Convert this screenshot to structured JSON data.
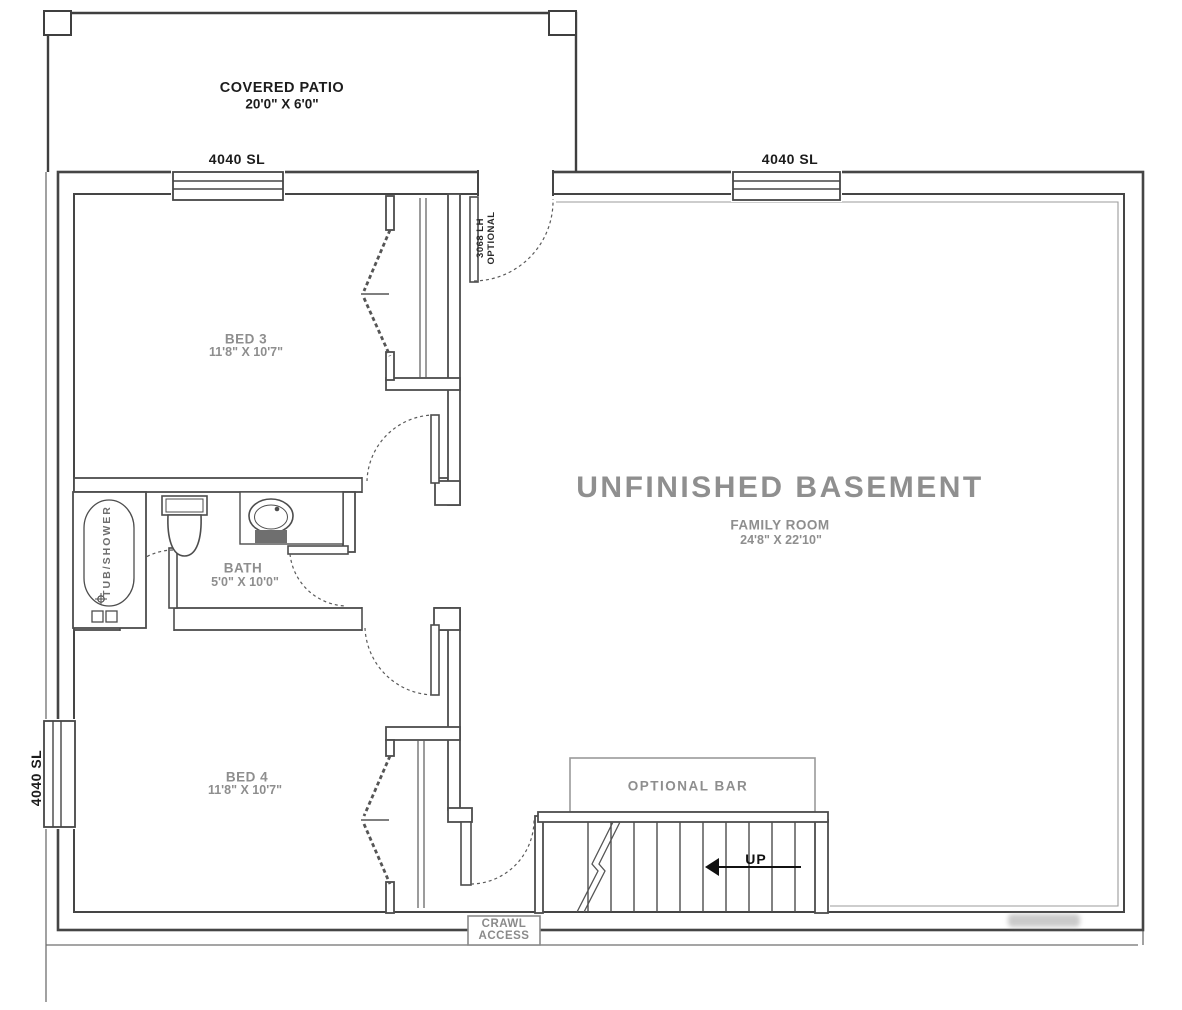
{
  "plan": {
    "patio": {
      "name": "COVERED PATIO",
      "dims": "20'0\" X 6'0\""
    },
    "windows": {
      "top_left": "4040 SL",
      "top_right": "4040 SL",
      "left": "4040 SL"
    },
    "entry_door": {
      "line1": "3068 LH",
      "line2": "OPTIONAL"
    },
    "rooms": {
      "bed3": {
        "name": "BED 3",
        "dims": "11'8\" X 10'7\""
      },
      "bed4": {
        "name": "BED 4",
        "dims": "11'8\" X 10'7\""
      },
      "bath": {
        "name": "BATH",
        "dims": "5'0\" X 10'0\""
      },
      "basement": {
        "title": "UNFINISHED BASEMENT"
      },
      "family_room": {
        "name": "FAMILY ROOM",
        "dims": "24'8\" X 22'10\""
      }
    },
    "fixtures": {
      "tub": "TUB/SHOWER"
    },
    "stairs": {
      "up": "UP",
      "optional_bar": "OPTIONAL BAR"
    },
    "crawl_access": {
      "line1": "CRAWL",
      "line2": "ACCESS"
    },
    "colors": {
      "wall_line": "#4d4d4d",
      "label_dark": "#1c1c1c",
      "label_gray": "#8e8e8e",
      "sink_base": "#6f6f6f"
    }
  }
}
